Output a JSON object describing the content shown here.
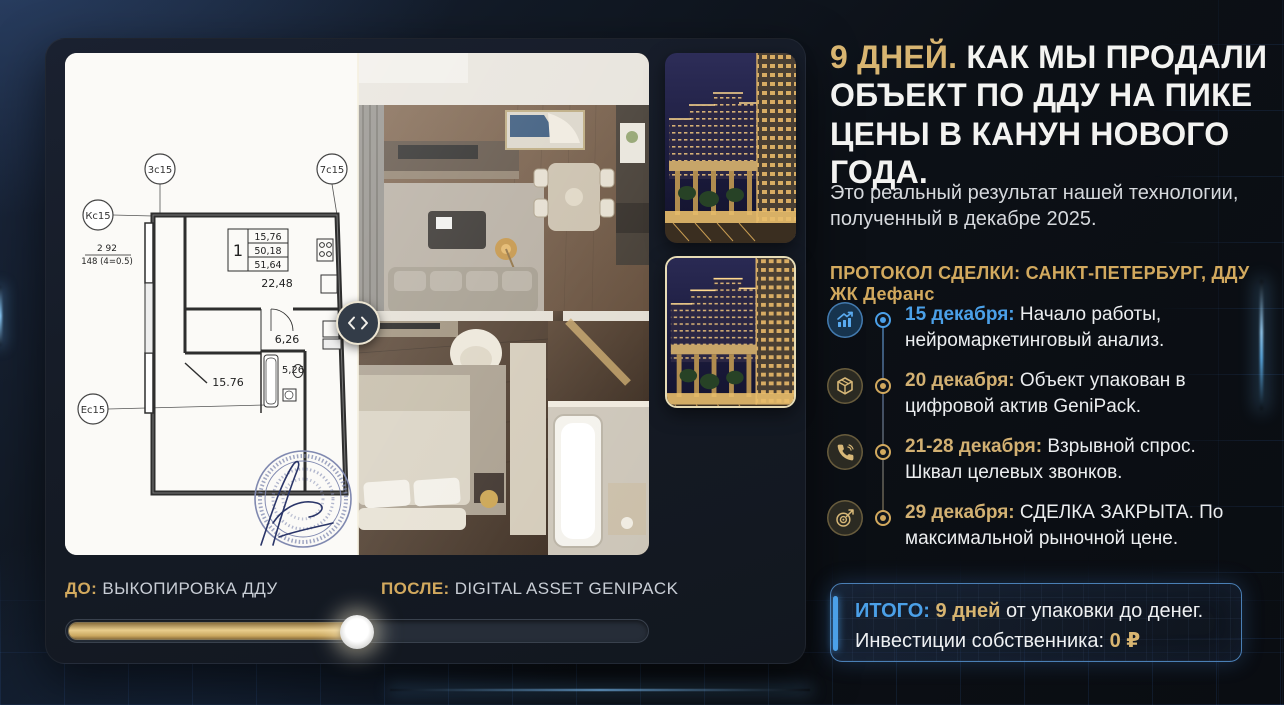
{
  "comparison": {
    "before": {
      "prefix": "ДО:",
      "label": "ВЫКОПИРОВКА ДДУ"
    },
    "after": {
      "prefix": "ПОСЛЕ:",
      "label": "DIGITAL ASSET GENIPACK"
    },
    "slider": {
      "percent": 50
    },
    "plan": {
      "axis_circles": [
        "3с15",
        "7с15",
        "Кс15",
        "Ес15"
      ],
      "unit_table": {
        "unit": "1",
        "values": [
          "15,76",
          "50,18",
          "51,64"
        ]
      },
      "total_area": "22,48",
      "areas": {
        "hall": "6,26",
        "bath": "5,26",
        "room": "15.76"
      },
      "dimensions": {
        "line1": "2 92",
        "line2": "148 (4=0.5)"
      }
    }
  },
  "headline": {
    "accent": "9 ДНЕЙ.",
    "rest": " КАК МЫ ПРОДАЛИ ОБЪЕКТ ПО ДДУ НА ПИКЕ ЦЕНЫ В КАНУН НОВОГО ГОДА."
  },
  "subtitle": "Это реальный результат нашей технологии, полученный в декабре 2025.",
  "protocol_heading": "ПРОТОКОЛ СДЕЛКИ: САНКТ-ПЕТЕРБУРГ, ДДУ ЖК Дефанс",
  "timeline": {
    "items": [
      {
        "icon": "chart-up-icon",
        "accent": "blue",
        "date": "15 декабря:",
        "text": " Начало работы, нейромаркетинговый анализ."
      },
      {
        "icon": "package-icon",
        "accent": "gold",
        "date": "20 декабря:",
        "text": " Объект упакован в цифровой актив GeniPack."
      },
      {
        "icon": "phone-icon",
        "accent": "gold",
        "date": "21-28 декабря:",
        "text": " Взрывной спрос. Шквал целевых звонков."
      },
      {
        "icon": "target-icon",
        "accent": "gold",
        "date": "29 декабря:",
        "text": " СДЕЛКА ЗАКРЫТА. По максимальной рыночной цене."
      }
    ]
  },
  "summary": {
    "label": "ИТОГО:",
    "highlight": " 9 дней",
    "text": " от упаковки до денег.",
    "line2_label": "Инвестиции собственника: ",
    "line2_value": "0 ₽"
  },
  "colors": {
    "gold": "#d2a95e",
    "blue": "#4ba0e8"
  }
}
